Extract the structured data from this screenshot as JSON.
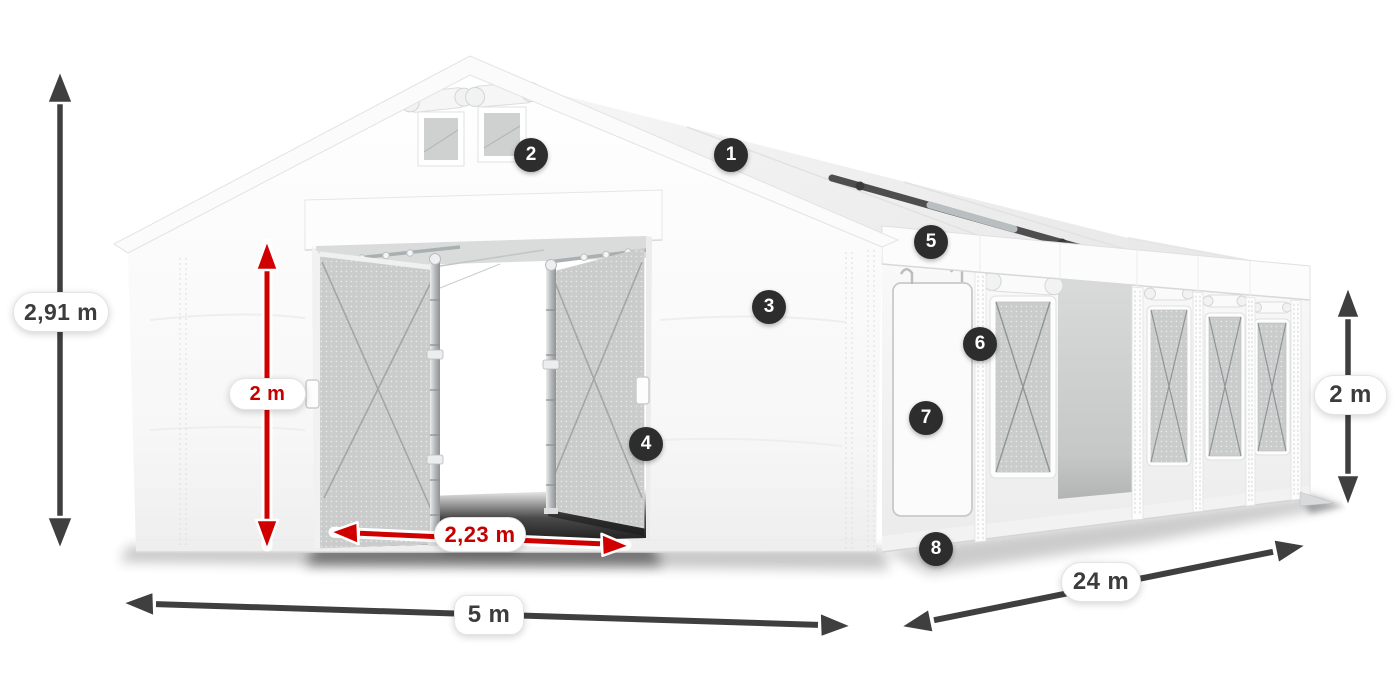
{
  "diagram": {
    "background": "#ffffff",
    "subject": "tent-with-dimensions"
  },
  "dimensions": {
    "total_height": {
      "label": "2,91 m"
    },
    "interior_height": {
      "label": "2 m"
    },
    "door_width": {
      "label": "2,23 m"
    },
    "width": {
      "label": "5 m"
    },
    "length": {
      "label": "24 m"
    },
    "side_height": {
      "label": "2 m"
    }
  },
  "markers": [
    {
      "number": "1"
    },
    {
      "number": "2"
    },
    {
      "number": "3"
    },
    {
      "number": "4"
    },
    {
      "number": "5"
    },
    {
      "number": "6"
    },
    {
      "number": "7"
    },
    {
      "number": "8"
    }
  ],
  "colors": {
    "arrow_dark": "#3f3f3f",
    "arrow_red": "#d10000",
    "label_dark": "#3c3c3c",
    "label_red": "#c40000",
    "marker_bg": "#2d2d2d",
    "marker_text": "#ffffff"
  }
}
